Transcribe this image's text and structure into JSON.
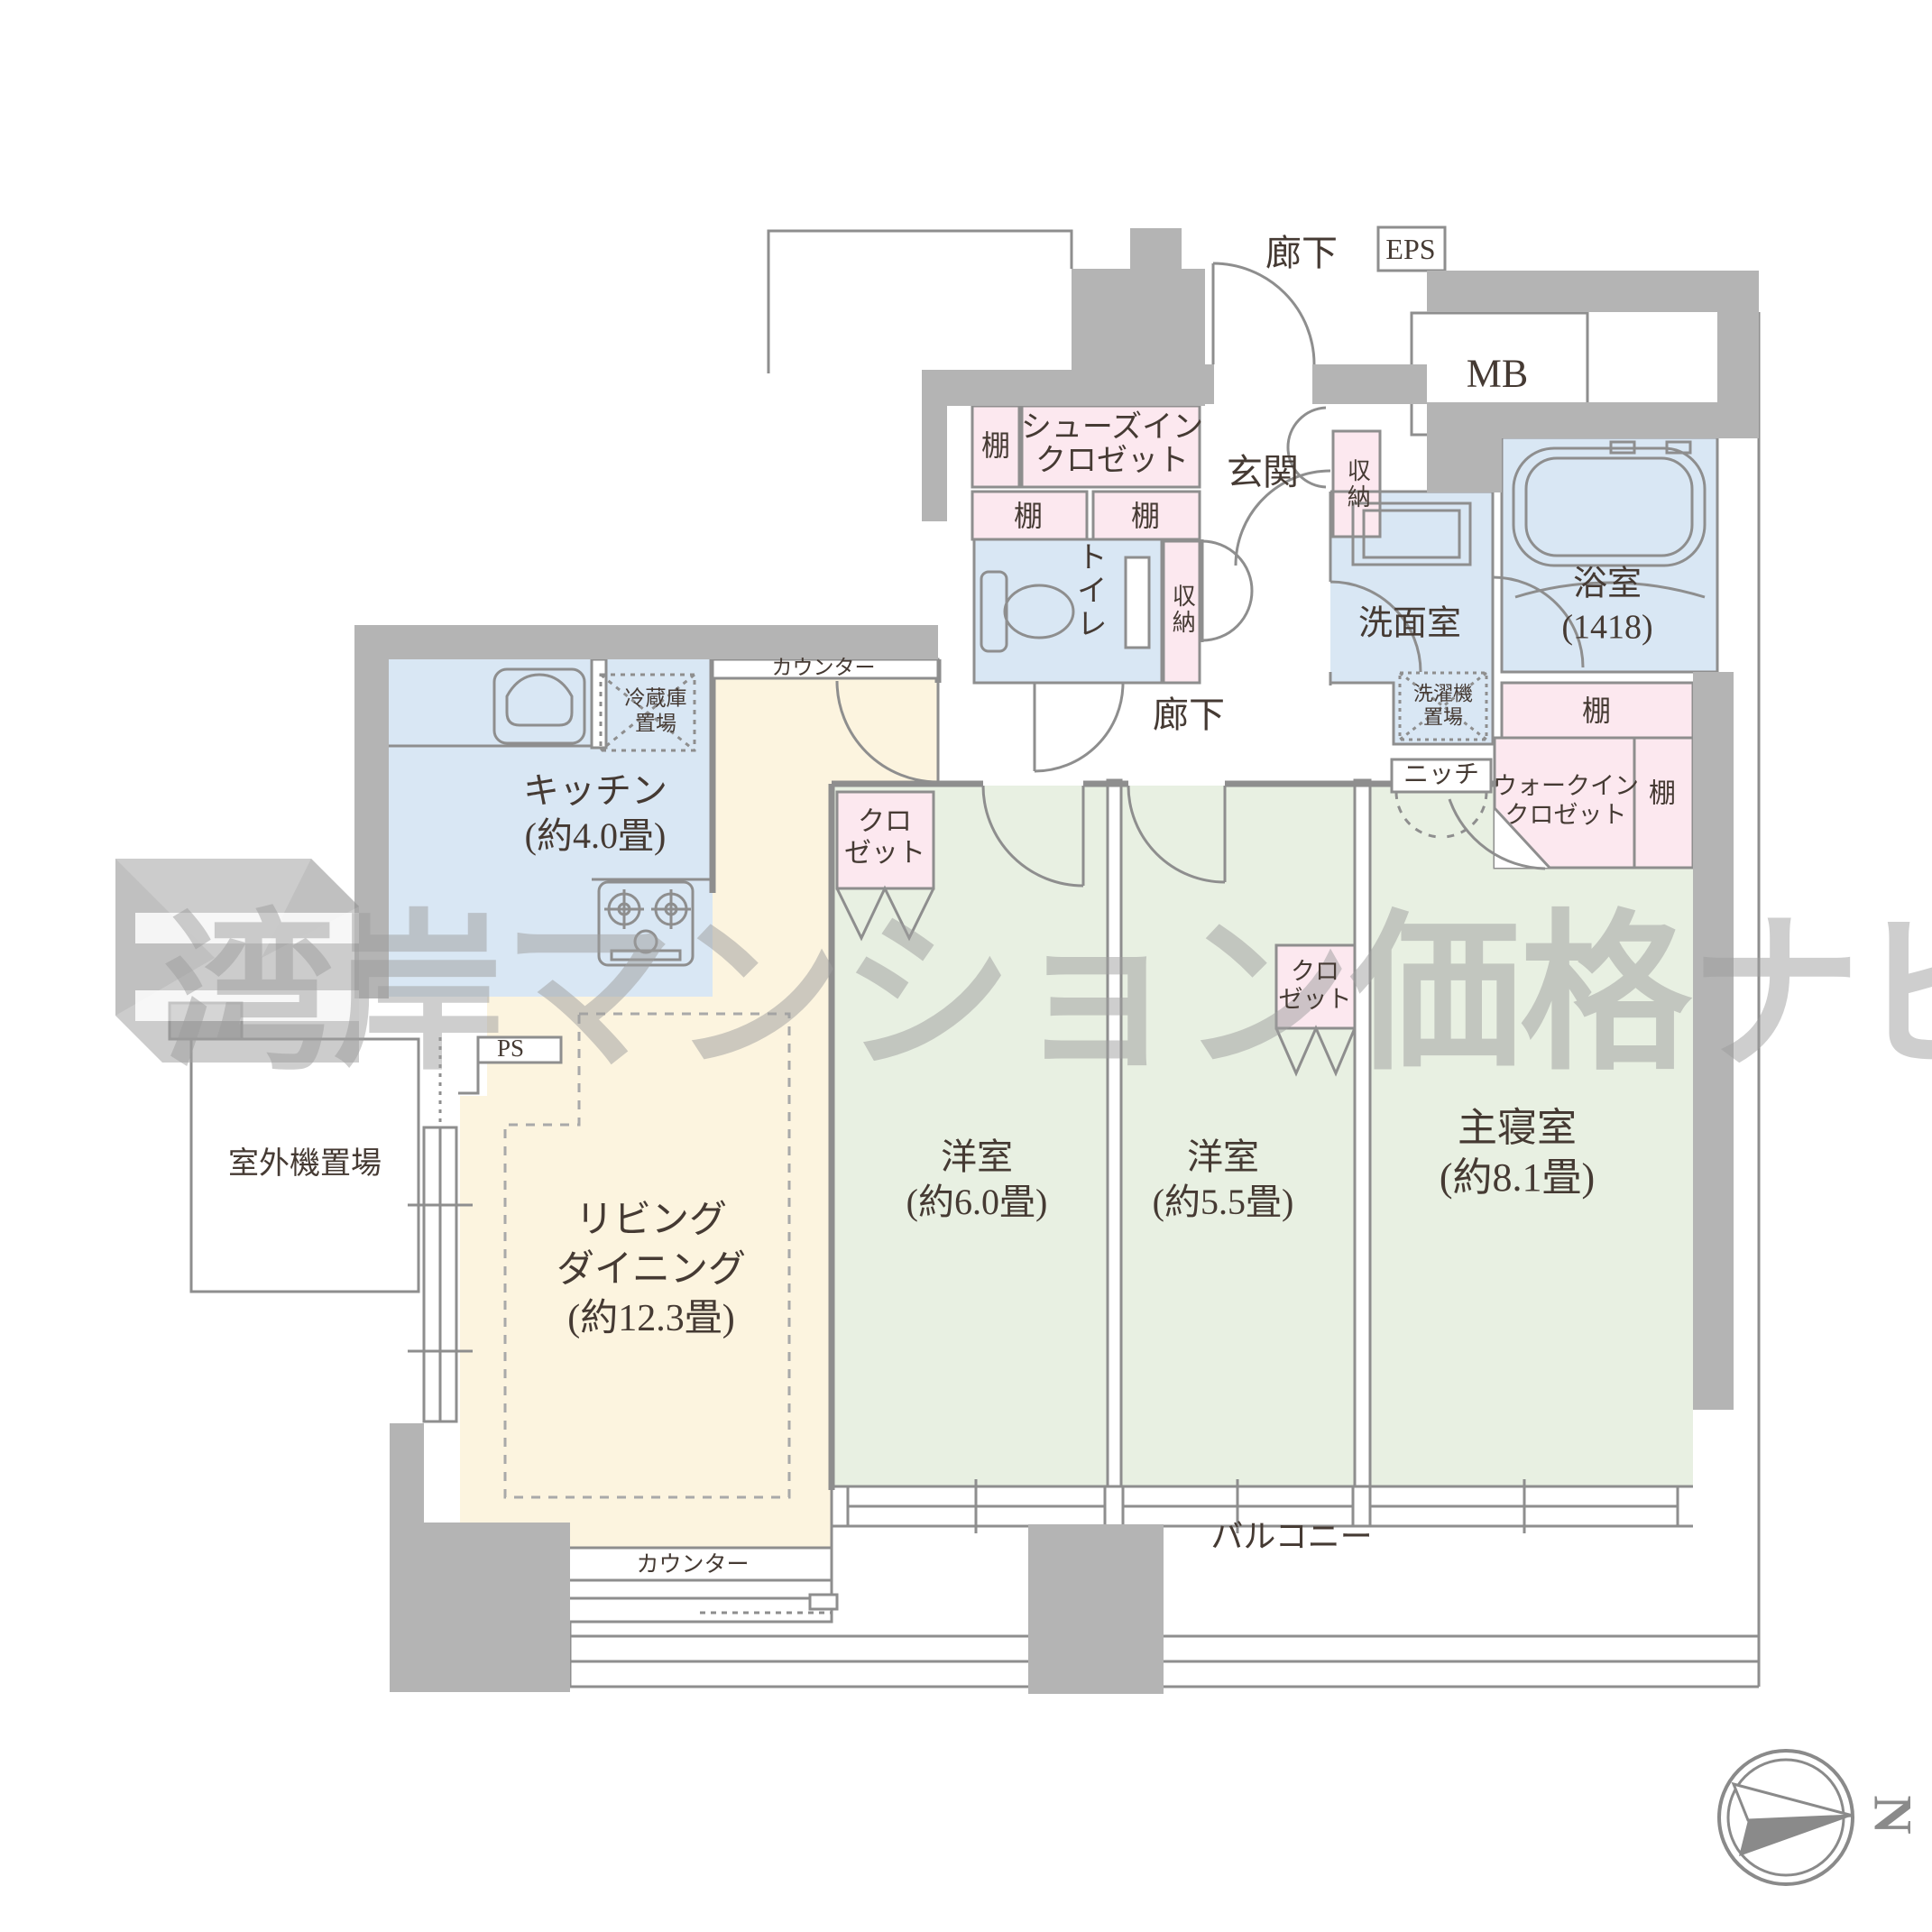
{
  "watermark": {
    "text": "湾岸マンション価格ナビ"
  },
  "compass": {
    "north": "N"
  },
  "common": {
    "corridor": "廊下",
    "eps": "EPS",
    "mb": "MB"
  },
  "entrance": {
    "genkan": "玄関",
    "shoes_closet": "シューズイン\nクロゼット",
    "shelf_a": "棚",
    "shelf_b": "棚",
    "shelf_c": "棚",
    "storage_side": "収納",
    "storage_hall": "収納",
    "hallway": "廊下"
  },
  "sanitary": {
    "toilet": "トイレ",
    "washroom": "洗面室",
    "bathroom": "浴室\n(1418)",
    "laundry": "洗濯機\n置場",
    "bath_shelf": "棚"
  },
  "kitchen": {
    "label": "キッチン\n(約4.0畳)",
    "fridge": "冷蔵庫\n置場",
    "counter": "カウンター"
  },
  "living": {
    "label": "リビング\nダイニング\n(約12.3畳)",
    "counter": "カウンター",
    "ps": "PS"
  },
  "bedrooms": {
    "bedroom1": "洋室\n(約6.0畳)",
    "bedroom2": "洋室\n(約5.5畳)",
    "master": "主寝室\n(約8.1畳)",
    "closet1": "クロ\nゼット",
    "closet2": "クロ\nゼット",
    "wic": "ウォークイン\nクロゼット",
    "wic_shelf": "棚",
    "niche": "ニッチ"
  },
  "outdoor": {
    "unit_space": "室外機置場",
    "balcony": "バルコニー"
  },
  "colors": {
    "wall": "#b4b4b4",
    "line": "#8e8e8e",
    "wet_area": "#d9e7f4",
    "living_area": "#fcf4df",
    "bedroom_area": "#e8f0e2",
    "storage_area": "#fce8ef",
    "text": "#453a33",
    "watermark": "#9e9e9e"
  }
}
